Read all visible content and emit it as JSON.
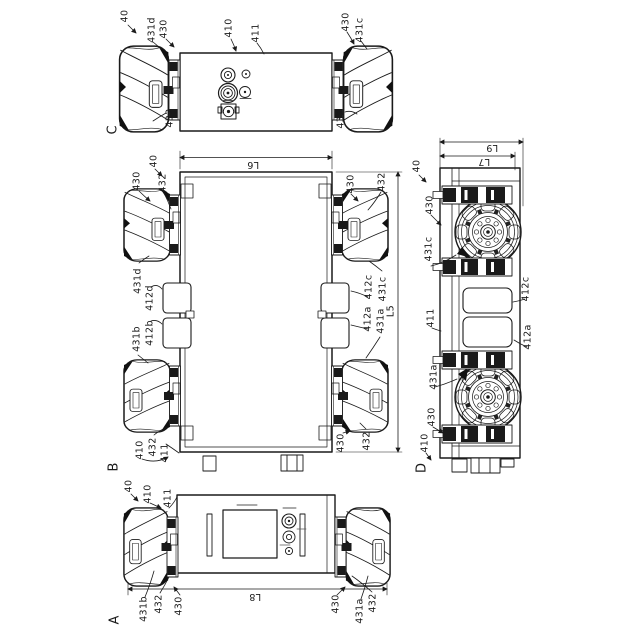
{
  "figure": {
    "type": "patent orthographic drawing of mecanum-wheel carriage",
    "background": "#ffffff",
    "line_color": "#1a1a1a",
    "view_letters": [
      "A",
      "B",
      "C",
      "D"
    ]
  },
  "labels": [
    {
      "name": "ref-40-view-c",
      "text": "40",
      "x": 125,
      "y": 16
    },
    {
      "name": "ref-431d-view-c",
      "text": "431d",
      "x": 152,
      "y": 30
    },
    {
      "name": "ref-430-view-c-left",
      "text": "430",
      "x": 164,
      "y": 29
    },
    {
      "name": "ref-410-view-c",
      "text": "410",
      "x": 229,
      "y": 28
    },
    {
      "name": "ref-411-view-c",
      "text": "411",
      "x": 256,
      "y": 33
    },
    {
      "name": "ref-430-view-c-right",
      "text": "430",
      "x": 346,
      "y": 22
    },
    {
      "name": "ref-431c-view-c",
      "text": "431c",
      "x": 360,
      "y": 30
    },
    {
      "name": "ref-432-view-c-left",
      "text": "432",
      "x": 170,
      "y": 118
    },
    {
      "name": "ref-432-view-c-right",
      "text": "432",
      "x": 341,
      "y": 119
    },
    {
      "name": "view-letter-c",
      "text": "C",
      "x": 113,
      "y": 130,
      "size": "big"
    },
    {
      "name": "ref-40-view-b",
      "text": "40",
      "x": 154,
      "y": 161
    },
    {
      "name": "ref-430-view-b-tl",
      "text": "430",
      "x": 137,
      "y": 181
    },
    {
      "name": "ref-432-view-b-tl",
      "text": "432",
      "x": 163,
      "y": 183
    },
    {
      "name": "dim-l6",
      "text": "L6",
      "x": 253,
      "y": 164,
      "rot": 180
    },
    {
      "name": "ref-430-view-b-tr",
      "text": "430",
      "x": 351,
      "y": 184
    },
    {
      "name": "ref-432-view-b-tr",
      "text": "432",
      "x": 382,
      "y": 182
    },
    {
      "name": "ref-431d-view-b",
      "text": "431d",
      "x": 138,
      "y": 281
    },
    {
      "name": "ref-412d-view-b",
      "text": "412d",
      "x": 150,
      "y": 298
    },
    {
      "name": "ref-412b-view-b",
      "text": "412b",
      "x": 150,
      "y": 333
    },
    {
      "name": "ref-431b-view-b",
      "text": "431b",
      "x": 137,
      "y": 339
    },
    {
      "name": "ref-412c-view-b",
      "text": "412c",
      "x": 369,
      "y": 287
    },
    {
      "name": "ref-431c-view-b",
      "text": "431c",
      "x": 383,
      "y": 289
    },
    {
      "name": "ref-412a-view-b",
      "text": "412a",
      "x": 368,
      "y": 319
    },
    {
      "name": "ref-431a-view-b",
      "text": "431a",
      "x": 381,
      "y": 321
    },
    {
      "name": "dim-l5",
      "text": "L5",
      "x": 391,
      "y": 311
    },
    {
      "name": "ref-410-view-b",
      "text": "410",
      "x": 140,
      "y": 450
    },
    {
      "name": "ref-432-view-b-bl",
      "text": "432",
      "x": 153,
      "y": 447
    },
    {
      "name": "ref-411-view-b",
      "text": "411",
      "x": 165,
      "y": 453
    },
    {
      "name": "ref-430-view-b-br",
      "text": "430",
      "x": 341,
      "y": 443
    },
    {
      "name": "ref-432-view-b-br",
      "text": "432",
      "x": 367,
      "y": 441
    },
    {
      "name": "view-letter-b",
      "text": "B",
      "x": 114,
      "y": 467,
      "size": "big"
    },
    {
      "name": "ref-40-view-a",
      "text": "40",
      "x": 129,
      "y": 486
    },
    {
      "name": "ref-410-view-a",
      "text": "410",
      "x": 148,
      "y": 494
    },
    {
      "name": "ref-411-view-a",
      "text": "411",
      "x": 168,
      "y": 498
    },
    {
      "name": "ref-431b-view-a",
      "text": "431b",
      "x": 144,
      "y": 609
    },
    {
      "name": "ref-432-view-a-left",
      "text": "432",
      "x": 159,
      "y": 604
    },
    {
      "name": "ref-430-view-a-left",
      "text": "430",
      "x": 179,
      "y": 606
    },
    {
      "name": "dim-l8",
      "text": "L8",
      "x": 255,
      "y": 596,
      "rot": 180
    },
    {
      "name": "ref-430-view-a-right",
      "text": "430",
      "x": 336,
      "y": 604
    },
    {
      "name": "ref-431a-view-a",
      "text": "431a",
      "x": 360,
      "y": 611
    },
    {
      "name": "ref-432-view-a-right",
      "text": "432",
      "x": 373,
      "y": 603
    },
    {
      "name": "view-letter-a",
      "text": "A",
      "x": 115,
      "y": 620,
      "size": "big"
    },
    {
      "name": "ref-40-view-d",
      "text": "40",
      "x": 417,
      "y": 166
    },
    {
      "name": "dim-l9",
      "text": "L9",
      "x": 492,
      "y": 147,
      "rot": 180
    },
    {
      "name": "dim-l7",
      "text": "L7",
      "x": 484,
      "y": 161,
      "rot": 180
    },
    {
      "name": "ref-430-view-d-top",
      "text": "430",
      "x": 430,
      "y": 205
    },
    {
      "name": "ref-431c-view-d",
      "text": "431c",
      "x": 429,
      "y": 249
    },
    {
      "name": "ref-412c-view-d",
      "text": "412c",
      "x": 526,
      "y": 289
    },
    {
      "name": "ref-411-view-d",
      "text": "411",
      "x": 431,
      "y": 318
    },
    {
      "name": "ref-412a-view-d",
      "text": "412a",
      "x": 528,
      "y": 337
    },
    {
      "name": "ref-431a-view-d",
      "text": "431a",
      "x": 434,
      "y": 377
    },
    {
      "name": "ref-430-view-d-bottom",
      "text": "430",
      "x": 432,
      "y": 417
    },
    {
      "name": "ref-410-view-d",
      "text": "410",
      "x": 425,
      "y": 443
    },
    {
      "name": "view-letter-d",
      "text": "D",
      "x": 422,
      "y": 468,
      "size": "big"
    }
  ]
}
